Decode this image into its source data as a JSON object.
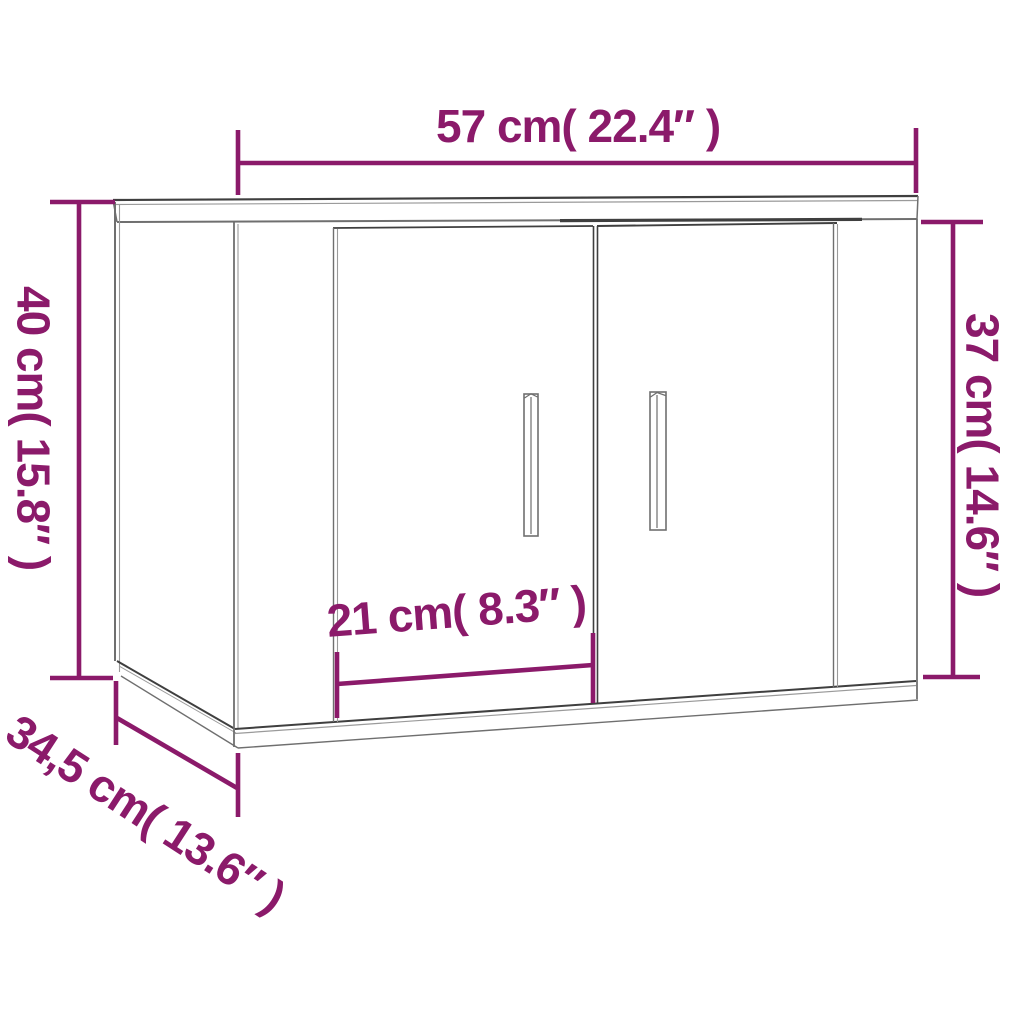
{
  "diagram": {
    "kind": "product-dimension-diagram",
    "subject": "wall-mounted cabinet with two doors"
  },
  "labels": {
    "width": "57 cm( 22.4″ )",
    "height_total": "40 cm( 15.8″ )",
    "height_front": "37 cm( 14.6″ )",
    "door_width": "21 cm( 8.3″ )",
    "depth": "34,5 cm( 13.6″ )"
  },
  "values": {
    "width_cm": 57,
    "width_in": 22.4,
    "height_total_cm": 40,
    "height_total_in": 15.8,
    "height_front_cm": 37,
    "height_front_in": 14.6,
    "door_width_cm": 21,
    "door_width_in": 8.3,
    "depth_cm": 34.5,
    "depth_in": 13.6
  },
  "colors": {
    "dimension_accent": "#8B1A6A",
    "outline_dark": "#3F3F3F",
    "outline_mid": "#6F6F6F",
    "outline_light": "#9A9A9A",
    "background": "#FFFFFF"
  }
}
